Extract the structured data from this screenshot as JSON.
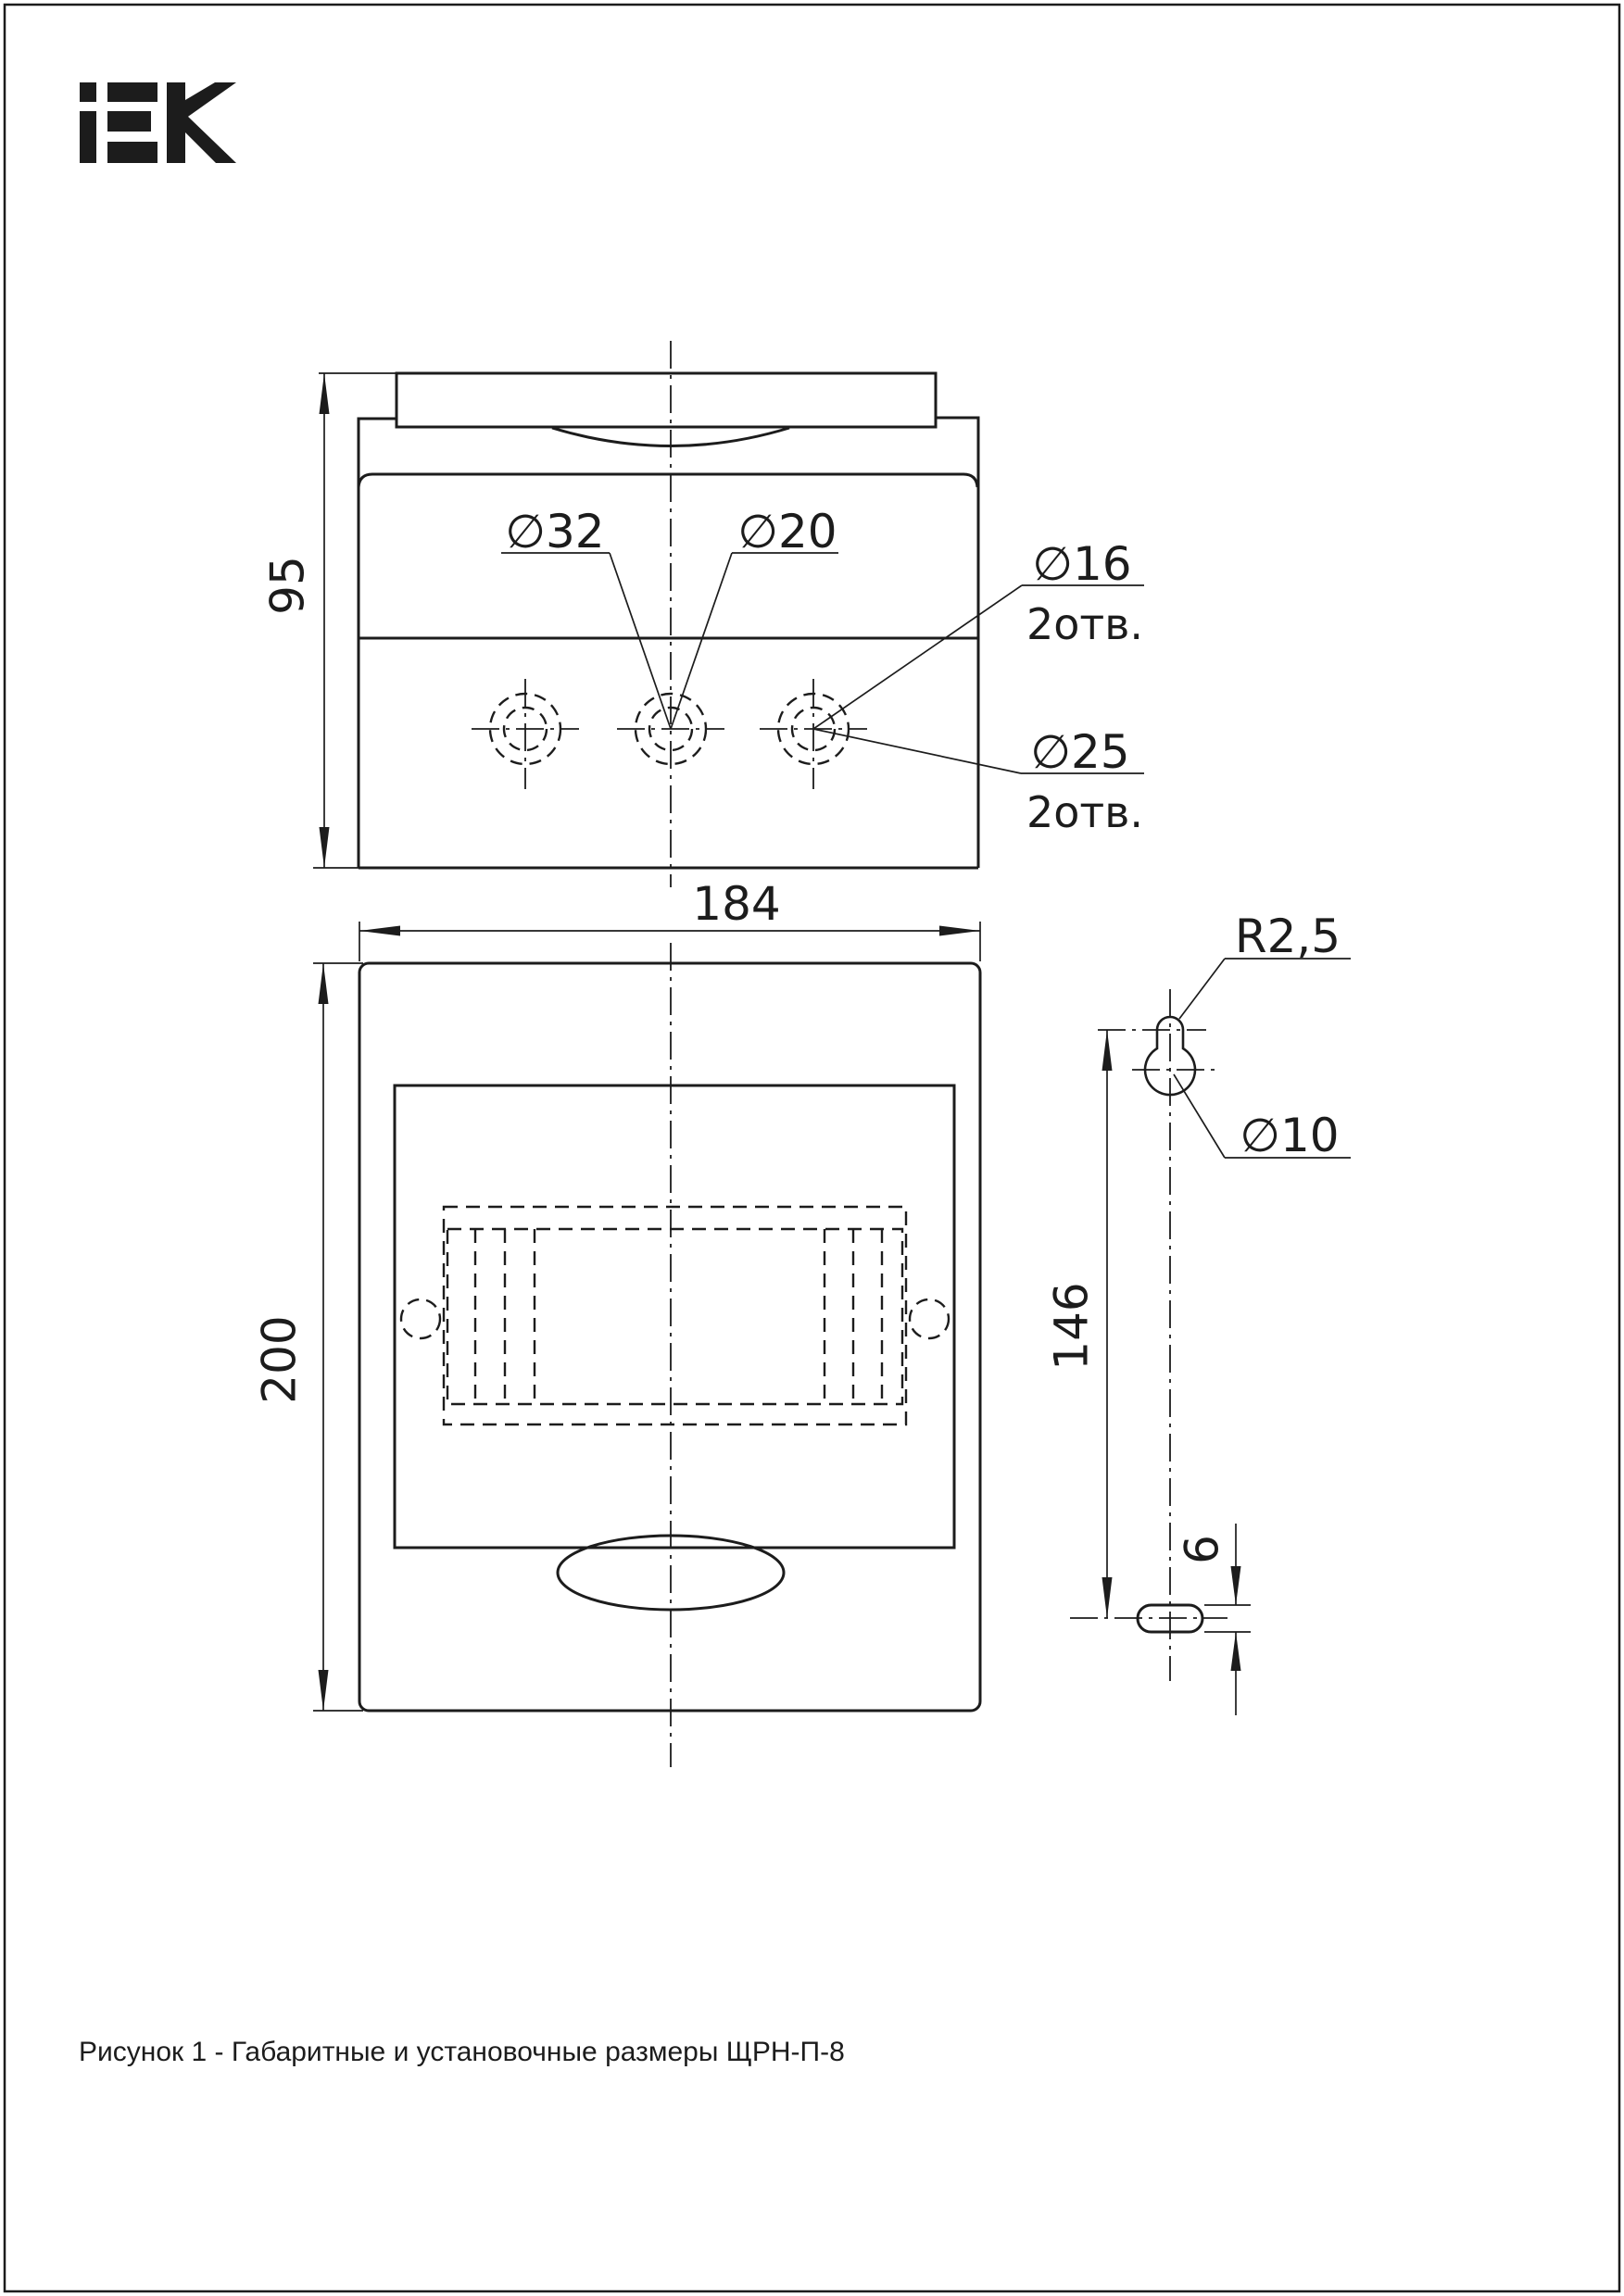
{
  "page": {
    "background": "#ffffff",
    "ink_color": "#1c1c1c",
    "caption": "Рисунок 1 - Габаритные и установочные размеры ЩРН-П-8"
  },
  "logo": {
    "brand": "IEK"
  },
  "top_view": {
    "dim_depth": "95",
    "knockout_labels": {
      "d32": "∅32",
      "d20": "∅20",
      "d16": "∅16",
      "d16_qty": "2отв.",
      "d25": "∅25",
      "d25_qty": "2отв."
    }
  },
  "front_view": {
    "dim_width": "184",
    "dim_height": "200"
  },
  "mount_detail": {
    "keyhole_radius": "R2,5",
    "keyhole_hole": "∅10",
    "dim_span": "146",
    "slot_height": "6"
  }
}
